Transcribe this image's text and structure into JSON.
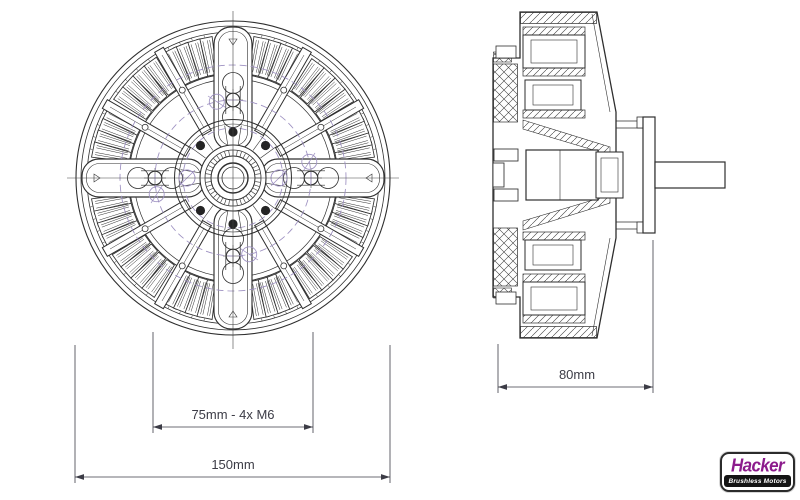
{
  "drawing": {
    "background": "#ffffff",
    "line_color": "#2e2e2e",
    "dash_color": "#9d90c1",
    "dim_color": "#3c3c46"
  },
  "views": {
    "front": {
      "name": "front-view"
    },
    "side": {
      "name": "side-view-cross-section"
    }
  },
  "dimensions": {
    "bolt_circle": {
      "label": "75mm - 4x M6",
      "value_mm": 75,
      "fastener": "4x M6"
    },
    "outer_diameter": {
      "label": "150mm",
      "value_mm": 150
    },
    "overall_length": {
      "label": "80mm",
      "value_mm": 80
    }
  },
  "logo": {
    "brand": "Hacker",
    "tagline": "Brushless Motors",
    "brand_color": "#8c1b8c",
    "bar_color": "#141414"
  }
}
